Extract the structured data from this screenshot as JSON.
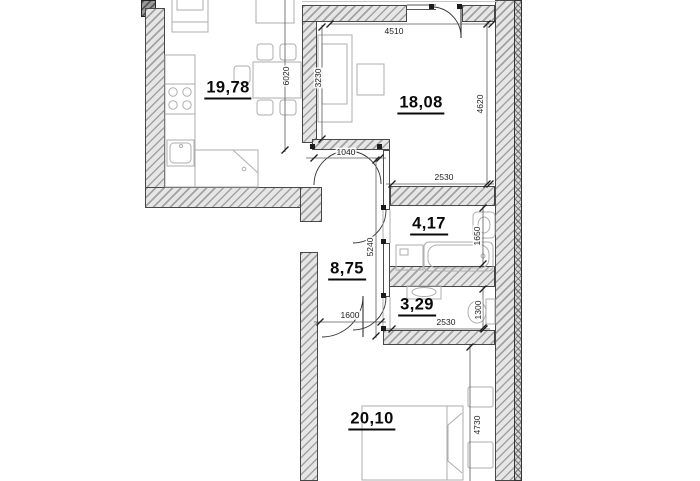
{
  "plan": {
    "type": "apartment floor plan",
    "room_labels": {
      "kitchen": "19,78",
      "living": "18,08",
      "bathroom": "4,17",
      "hallway": "8,75",
      "wc": "3,29",
      "bedroom": "20,10"
    },
    "dimension_labels": {
      "living_width": "4510",
      "kitchen_height": "6020",
      "living_left_height": "3230",
      "living_right_height": "4620",
      "hall_door_width": "1040",
      "bathroom_width": "2530",
      "hallway_length": "5240",
      "bathroom_height": "1650",
      "bedroom_door_width": "1600",
      "wc_height": "1300",
      "wc_width": "2530",
      "bedroom_height": "4730"
    }
  }
}
